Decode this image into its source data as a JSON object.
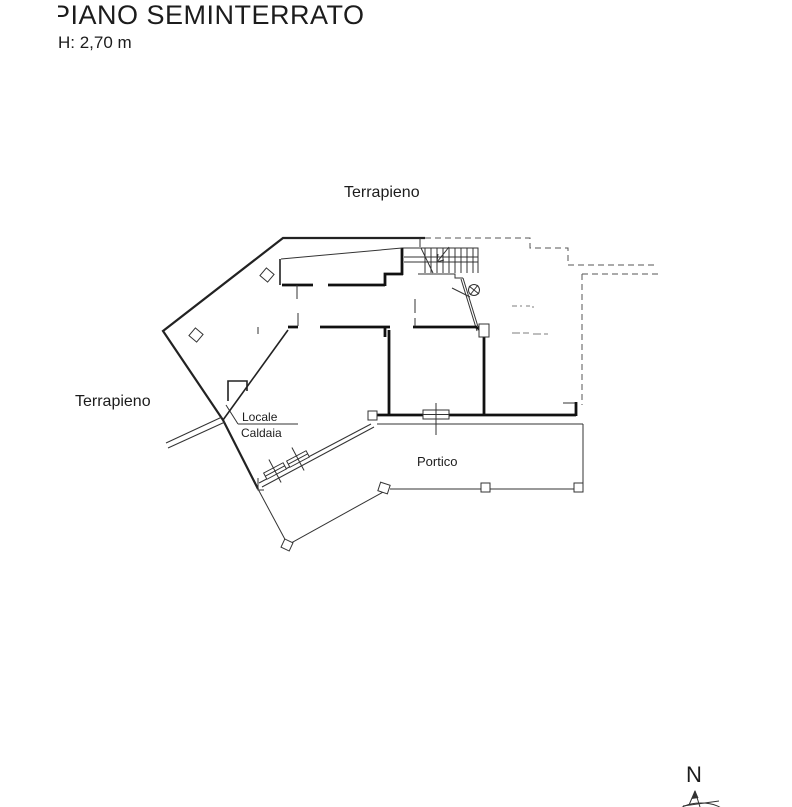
{
  "drawing": {
    "title": "PIANO SEMINTERRATO",
    "height_note": "H: 2,70 m",
    "labels": {
      "terrapieno_top": "Terrapieno",
      "terrapieno_left": "Terrapieno",
      "boiler_room_line1": "Locale",
      "boiler_room_line2": "Caldaia",
      "portico": "Portico"
    },
    "compass": {
      "north": "N"
    },
    "colors": {
      "ink": "#1c1c1c",
      "thick_wall": "#111111",
      "dashed_outline": "#555555",
      "faint_marks": "#a8a8a8",
      "background": "#ffffff"
    }
  }
}
